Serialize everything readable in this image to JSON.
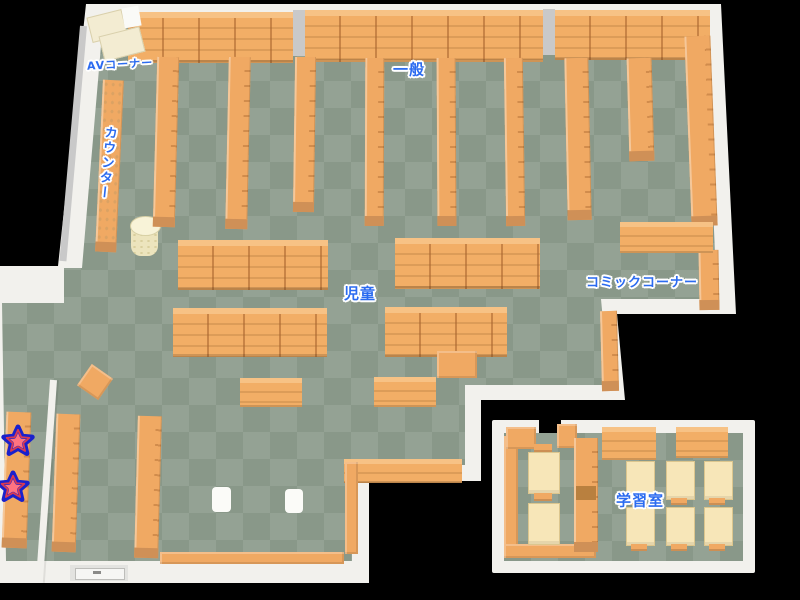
{
  "map": {
    "areas": {
      "av_corner": {
        "label": "AVコーナー"
      },
      "general": {
        "label": "一般"
      },
      "counter": {
        "label": "カウンター"
      },
      "children": {
        "label": "児童"
      },
      "comic_corner": {
        "label": "コミックコーナー"
      },
      "study_room": {
        "label": "学習室"
      }
    },
    "markers": {
      "star_count": 2
    },
    "colors": {
      "background": "#000000",
      "wall": "#f2f1ed",
      "floor_light": "#94a294",
      "floor_dark": "#899889",
      "shelf_orange": "#f0a963",
      "shelf_shadow": "#cf9057",
      "av_table_cream": "#f3ecd2",
      "desk_cream": "#f7e6b8",
      "label_blue": "#2b6bf0",
      "label_outline": "#ffffff",
      "star_fill": "#ff7380",
      "star_outline": "#1a20cc"
    }
  }
}
